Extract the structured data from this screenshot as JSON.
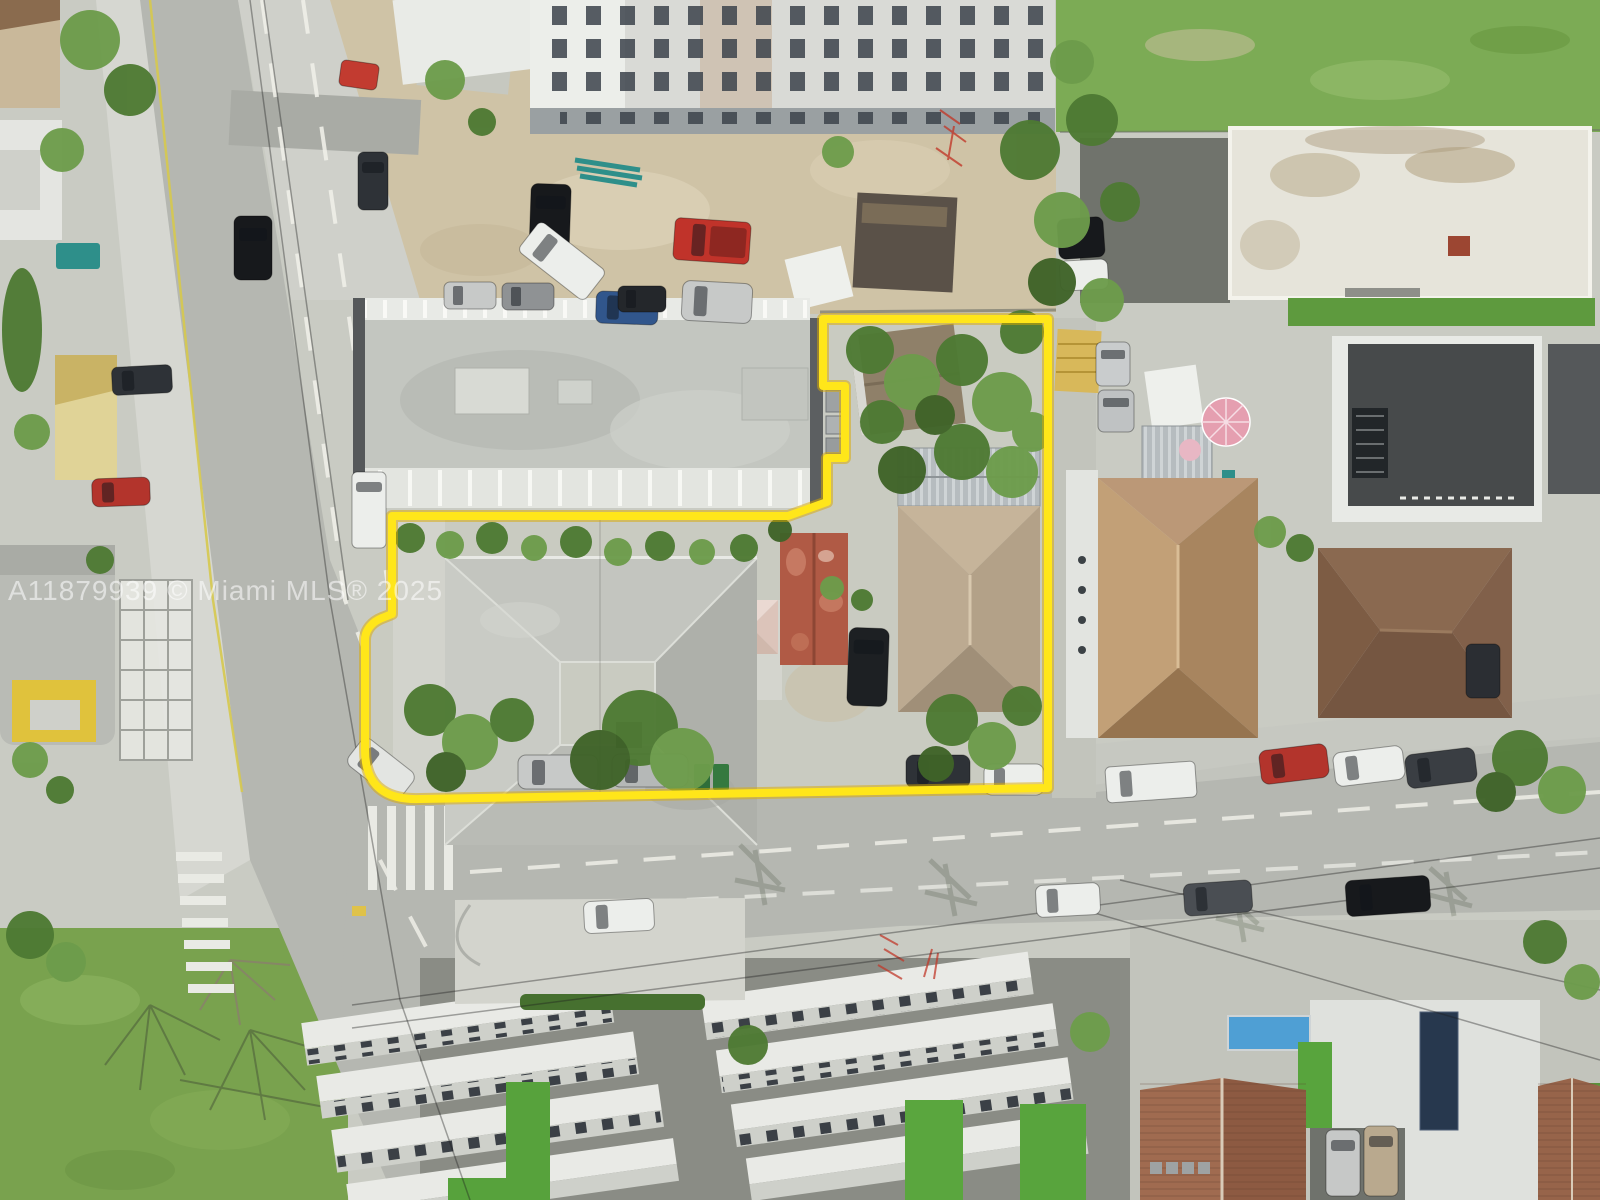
{
  "watermark": {
    "text": "A11879939 © Miami MLS® 2025"
  },
  "scene": {
    "type": "aerial-drone-photo",
    "colors": {
      "boundary_yellow": "#ffe61a",
      "boundary_shadow": "#d9a900",
      "watermark_white": "rgba(255,255,255,0.55)",
      "road_gray": "#b5b7b1",
      "grass_green": "#7cab55",
      "dirt_tan": "#cfc3a6"
    }
  }
}
